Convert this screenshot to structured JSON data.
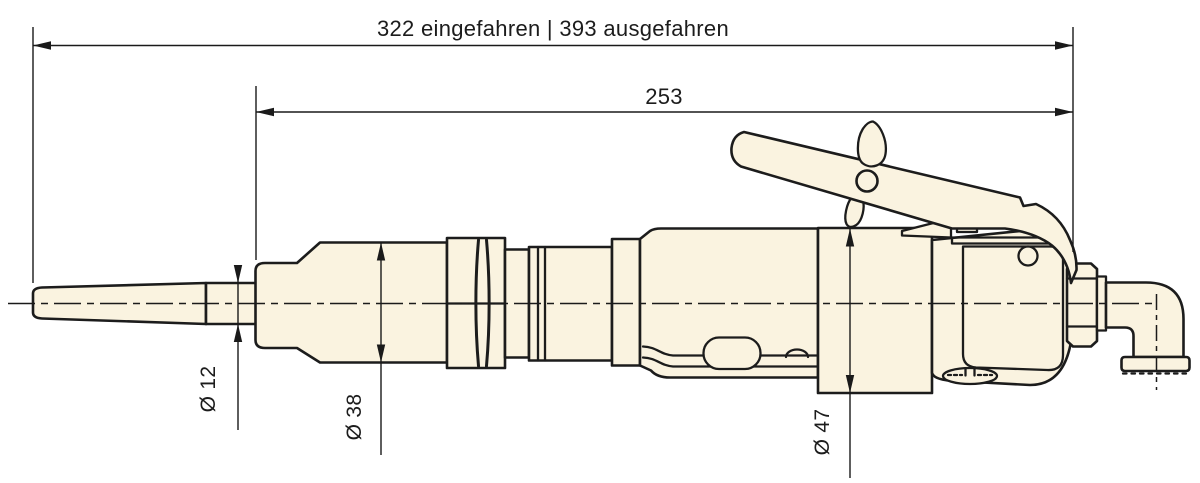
{
  "colors": {
    "background": "#ffffff",
    "part_fill": "#faf3e0",
    "outline": "#1c1c1c",
    "dimension_lines": "#1a1a1a"
  },
  "dimensions": {
    "overall_length": "322 eingefahren | 393 ausgefahren",
    "front_section_length": "253",
    "tip_diameter": "Ø 12",
    "nose_diameter": "Ø 38",
    "housing_diameter": "Ø 47"
  }
}
